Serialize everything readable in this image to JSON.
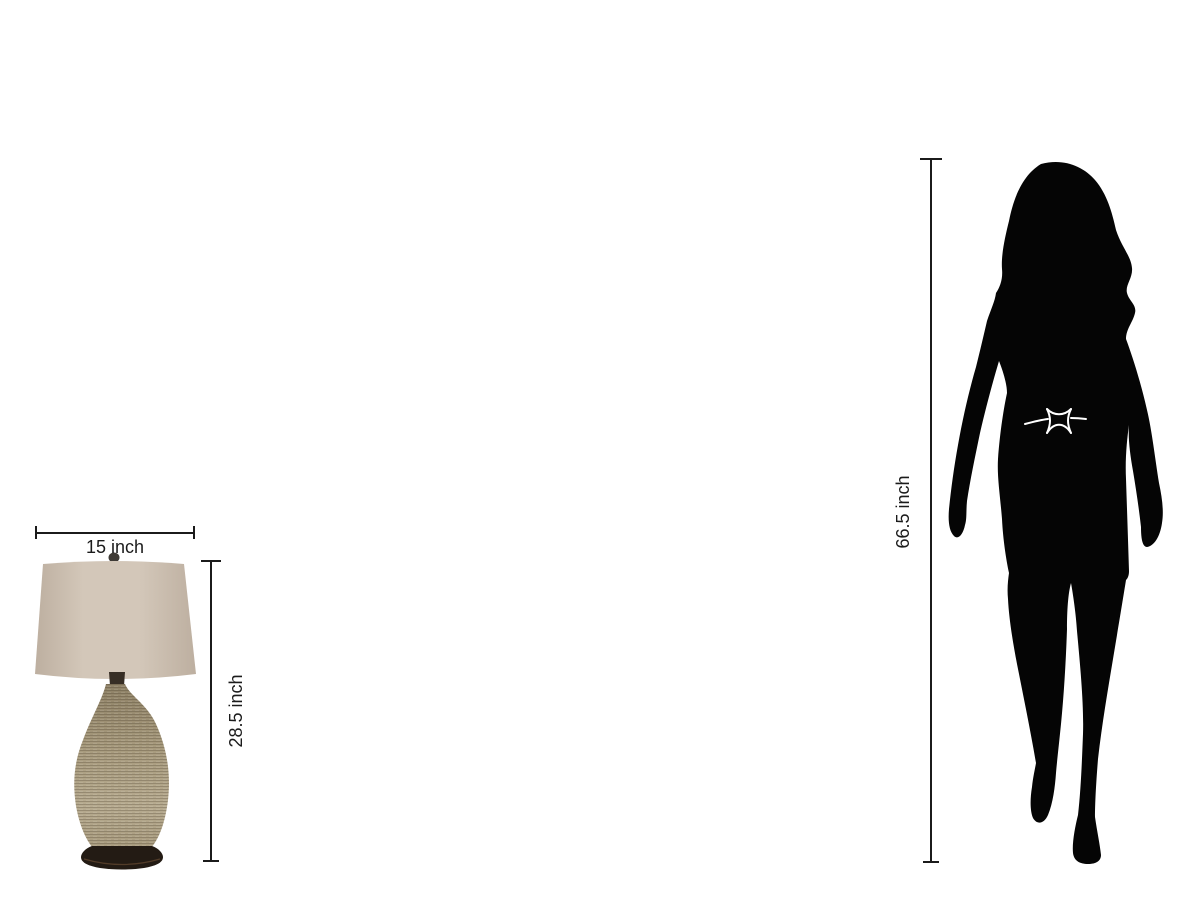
{
  "page": {
    "background_color": "#ffffff"
  },
  "lamp": {
    "width_label": "15 inch",
    "height_label": "28.5 inch",
    "colors": {
      "shade": "#d3c7b9",
      "shade_edge": "#bdafa0",
      "socket": "#372e25",
      "finial": "#3f3b36",
      "body_top": "#8f8267",
      "body": "#a89b7e",
      "body_light": "#b7ab90",
      "base": "#231b14",
      "base_rim": "#7a573a"
    }
  },
  "person": {
    "height_label": "66.5 inch",
    "silhouette_color": "#050505",
    "belt_color": "#ffffff"
  },
  "dimensions": {
    "line_color": "#1b1b1b"
  }
}
